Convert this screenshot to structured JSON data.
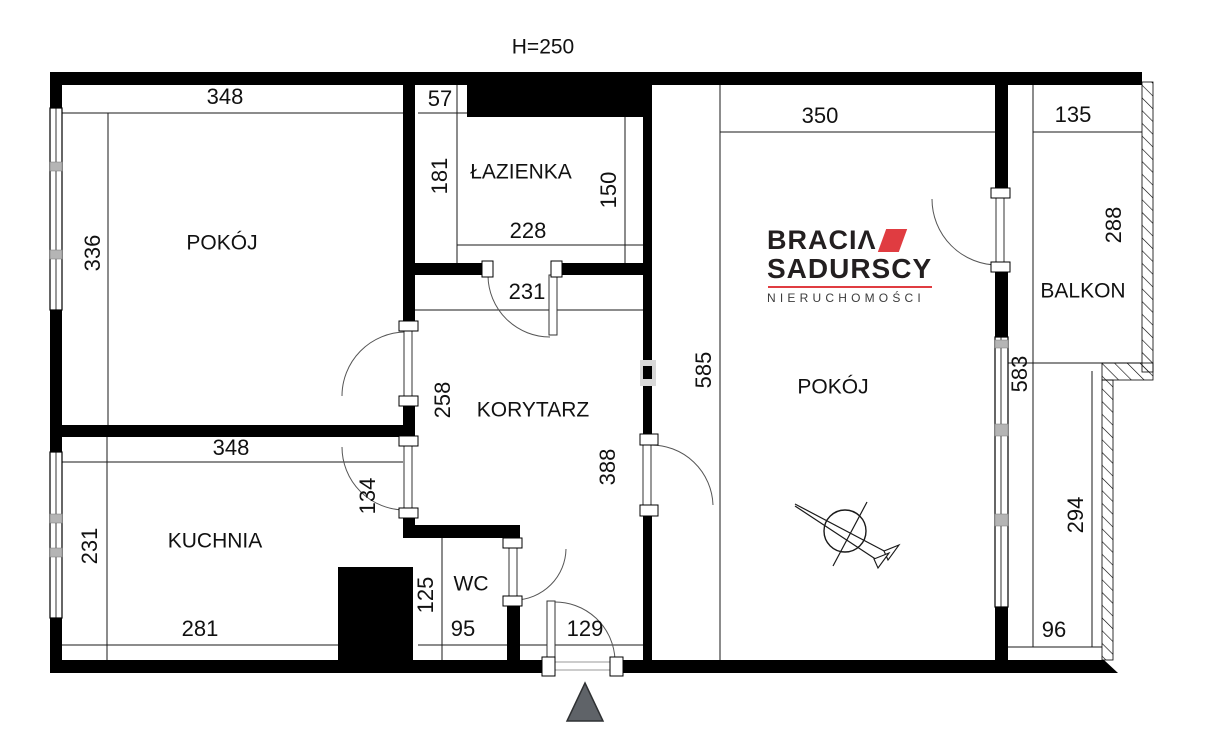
{
  "title": "H=250",
  "logo": {
    "brand_top": "BRACIΛ",
    "brand_bottom": "SADURSCY",
    "tagline": "NIERUCHOMOŚCI",
    "accent_color": "#e03c41",
    "text_color": "#231f20"
  },
  "rooms": {
    "pokoj_left": "POKÓJ",
    "lazienka": "ŁAZIENKA",
    "korytarz": "KORYTARZ",
    "kuchnia": "KUCHNIA",
    "wc": "WC",
    "pokoj_right": "POKÓJ",
    "balkon": "BALKON"
  },
  "dims": {
    "pokoj_left_w": "348",
    "pokoj_left_h": "336",
    "top_57": "57",
    "lazienka_181": "181",
    "lazienka_150": "150",
    "lazienka_228": "228",
    "korytarz_231": "231",
    "korytarz_258": "258",
    "korytarz_388": "388",
    "pokoj_right_w": "350",
    "pokoj_right_585": "585",
    "balkon_135": "135",
    "balkon_288": "288",
    "right_583": "583",
    "right_294": "294",
    "right_96": "96",
    "kuchnia_w": "348",
    "kuchnia_h": "231",
    "kuchnia_134": "134",
    "kuchnia_281": "281",
    "wc_125": "125",
    "wc_95": "95",
    "entry_129": "129"
  },
  "colors": {
    "wall": "#000000",
    "line": "#1a1a1a",
    "entrance_arrow_gray": "#5f6368",
    "window_mullion": "#b5b5b5"
  }
}
